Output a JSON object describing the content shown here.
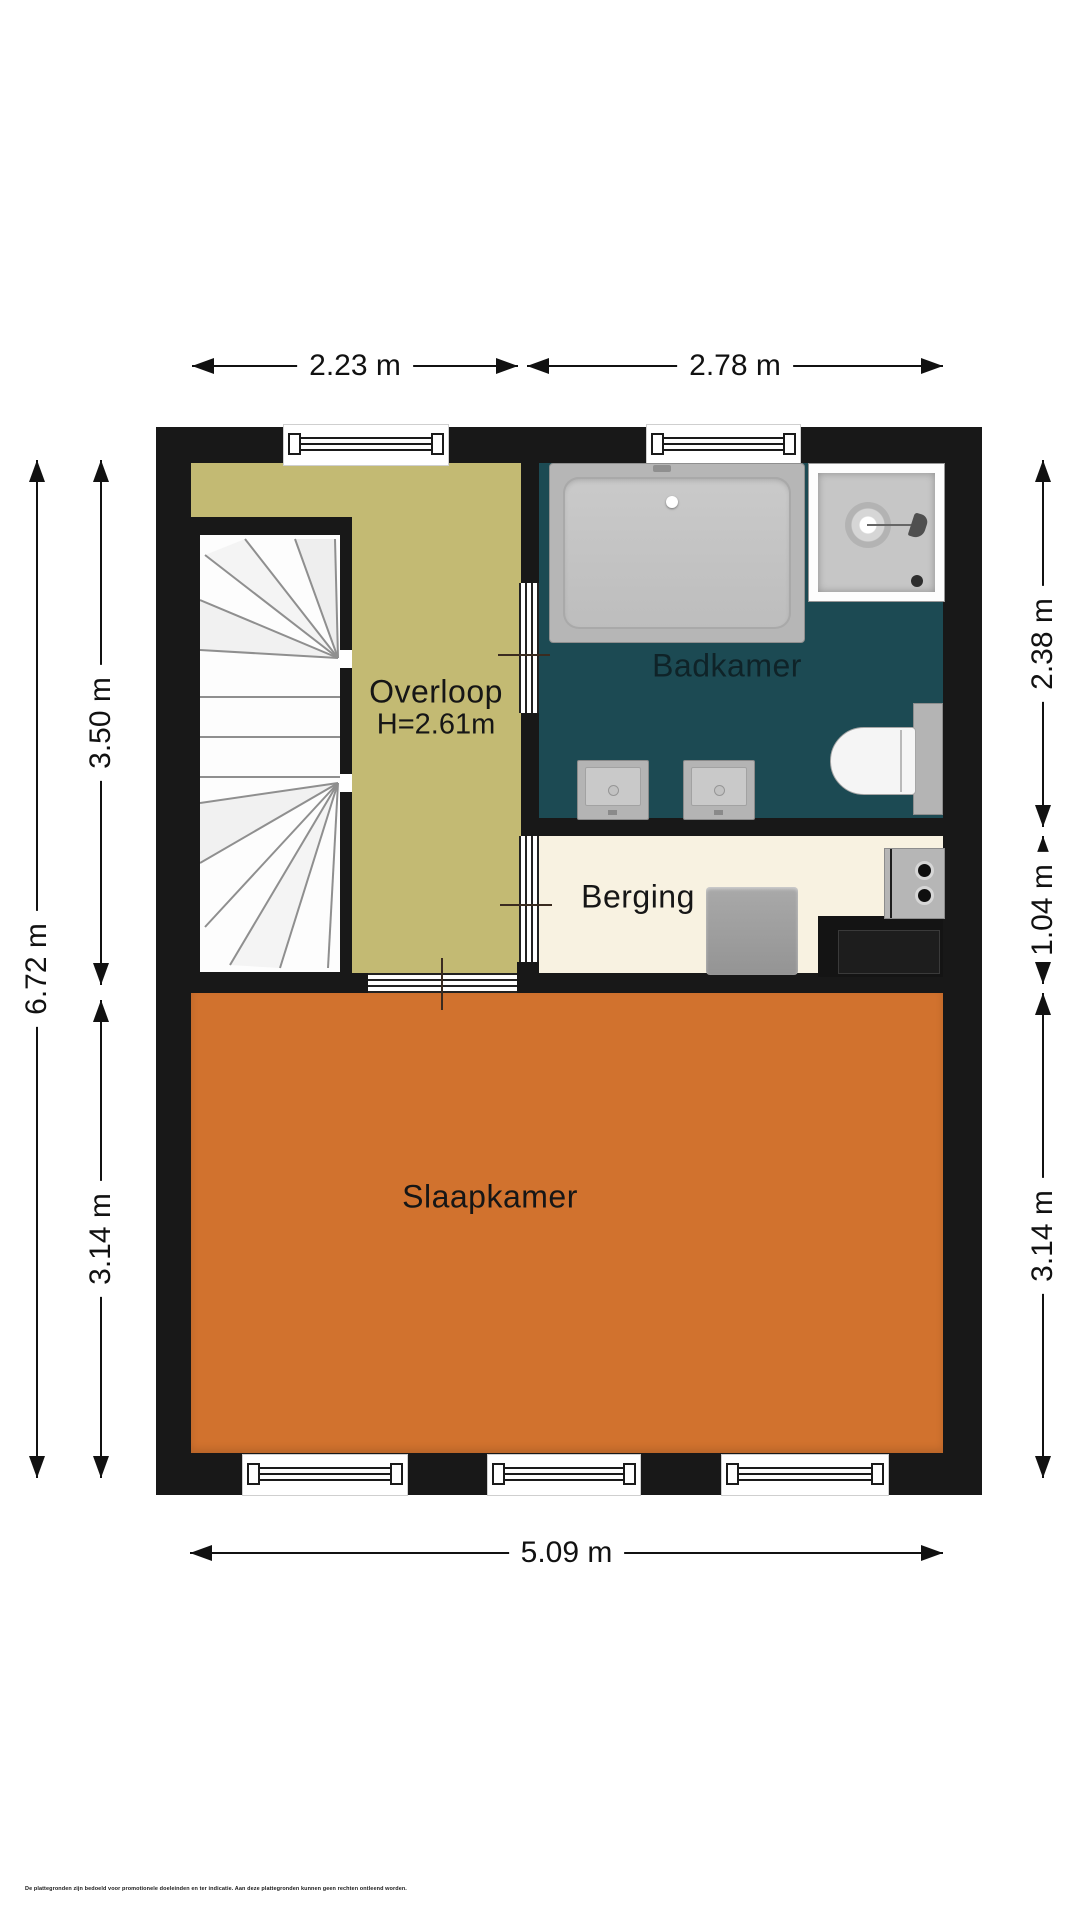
{
  "rooms": {
    "overloop": {
      "label": "Overloop",
      "height_note": "H=2.61m"
    },
    "badkamer": {
      "label": "Badkamer"
    },
    "berging": {
      "label": "Berging"
    },
    "slaapkamer": {
      "label": "Slaapkamer"
    }
  },
  "dimensions": {
    "top1": "2.23 m",
    "top2": "2.78 m",
    "left_total": "6.72 m",
    "left_upper": "3.50 m",
    "left_lower": "3.14 m",
    "right_upper": "2.38 m",
    "right_middle": "1.04 m",
    "right_lower": "3.14 m",
    "bottom_total": "5.09 m"
  },
  "fixtures": [
    "bathtub",
    "shower",
    "washbasin",
    "washbasin",
    "toilet",
    "boiler",
    "heater-unit",
    "staircase"
  ],
  "colors": {
    "wall": "#181818",
    "overloop_floor": "#c3ba73",
    "badkamer_floor": "#1c4a53",
    "berging_floor": "#f8f2e1",
    "slaapkamer_floor": "#d1722e"
  },
  "footer": {
    "disclaimer": "De plattegronden zijn bedoeld voor promotionele doeleinden en ter indicatie. Aan deze plattegronden kunnen geen rechten ontleend worden."
  }
}
